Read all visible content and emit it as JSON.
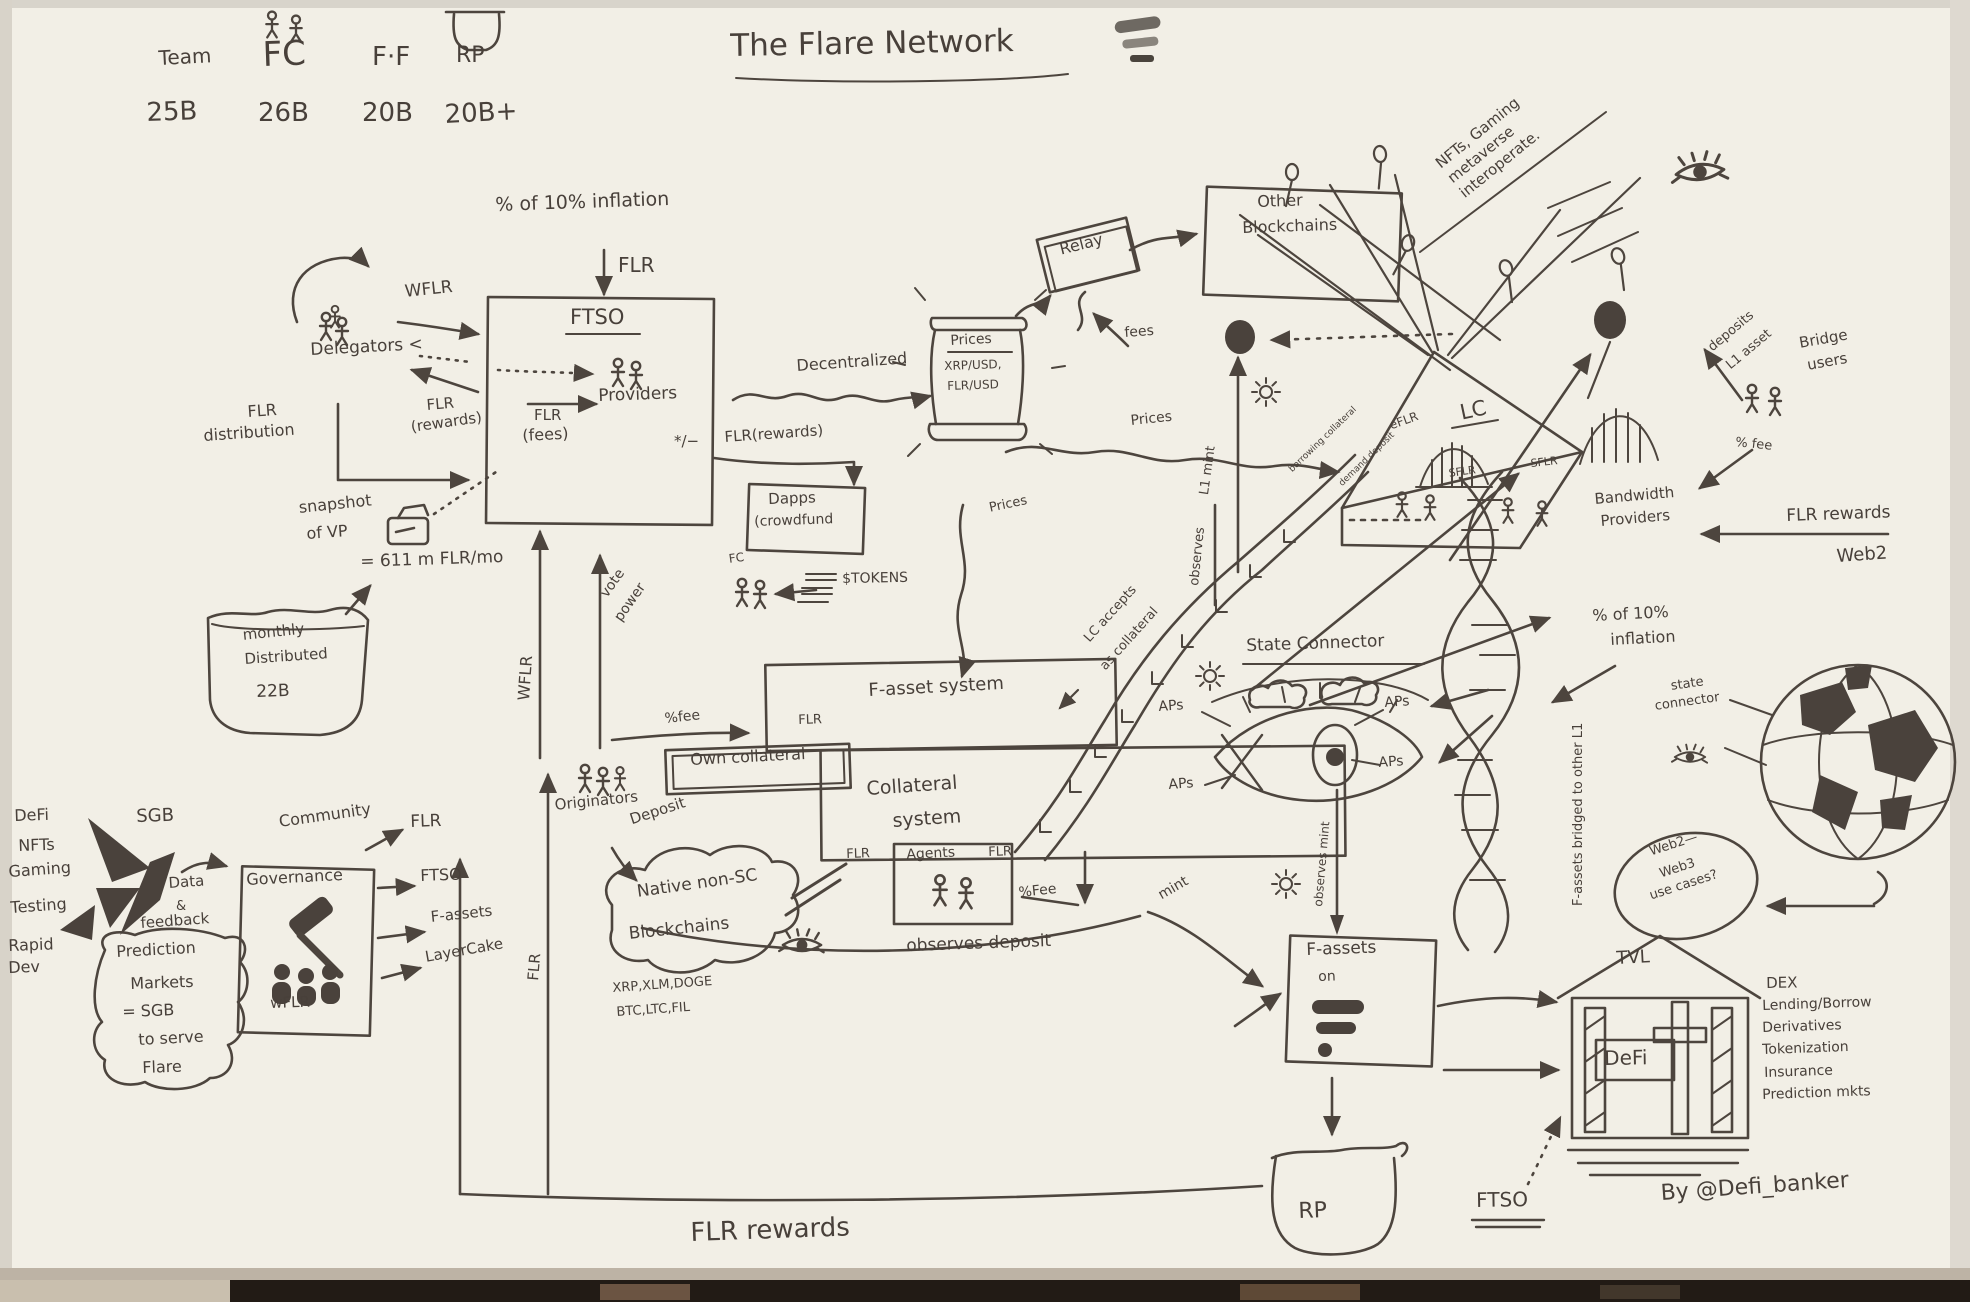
{
  "ink": "#4a423c",
  "header": {
    "team": "Team",
    "fc": "FC",
    "ff": "F·F",
    "rp": "RP",
    "team_val": "25B",
    "fc_val": "26B",
    "ff_val": "20B",
    "rp_val": "20B+"
  },
  "title": "The Flare Network",
  "inflation": {
    "pct": "% of 10% inflation",
    "flr": "FLR"
  },
  "ftso": {
    "name": "FTSO",
    "providers": "Providers",
    "flr": "FLR",
    "fees": "(fees)",
    "pm": "*/−",
    "wflr": "WFLR",
    "delegators": "Delegators <",
    "flr_r": "FLR",
    "rewards": "(rewards)",
    "flr_d": "FLR",
    "distribution": "distribution",
    "snapshot": "snapshot",
    "of_vp": "of VP",
    "rate": "= 611 m FLR/mo",
    "rewards_out": "FLR(rewards)"
  },
  "bucket": {
    "l1": "monthly",
    "l2": "Distributed",
    "l3": "22B"
  },
  "dapps": {
    "l1": "Dapps",
    "l2": "(crowdfund",
    "fc": "FC",
    "tokens": "$TOKENS"
  },
  "oracle": {
    "decentralized": "Decentralized",
    "prices": "Prices",
    "pair1": "XRP/USD,",
    "pair2": "FLR/USD",
    "relay": "Relay",
    "fees": "fees"
  },
  "chains": {
    "l1": "Other",
    "l2": "Blockchains"
  },
  "note": {
    "l1": "NFTs, Gaming",
    "l2": "metaverse",
    "l3": "interoperate."
  },
  "flows": {
    "wflr": "WFLR",
    "vote1": "vote",
    "vote2": "power",
    "flr": "FLR",
    "prices_r": "Prices",
    "prices_d": "Prices",
    "l1mint": "L1 mint",
    "observes": "observes",
    "accepts1": "LC accepts",
    "accepts2": "as collateral",
    "borrow": "borrowing collateral",
    "demand": "demand deposit"
  },
  "lc": {
    "name": "LC",
    "eflr": "eFLR",
    "sflr1": "SFLR",
    "sflr2": "SFLR",
    "bw1": "Bandwidth",
    "bw2": "Providers",
    "rewards": "FLR rewards",
    "pct10_1": "% of 10%",
    "pct10_2": "inflation"
  },
  "bridge": {
    "dep1": "deposits",
    "dep2": "L1 asset",
    "users1": "Bridge",
    "users2": "users",
    "fee": "% fee"
  },
  "sc": {
    "title": "State Connector",
    "ap1": "APs",
    "ap2": "APs",
    "ap3": "APs",
    "ap4": "APs",
    "observes_mint": "observes mint",
    "mint": "mint"
  },
  "fasset": {
    "system": "F-asset system",
    "flr": "FLR",
    "fee": "%fee",
    "own": "Own collateral",
    "col1": "Collateral",
    "col2": "system",
    "flr_l": "FLR",
    "agents": "Agents",
    "flr_r": "FLR",
    "fee2": "%Fee",
    "orig": "Originators",
    "deposit": "Deposit",
    "obs_dep": "observes deposit",
    "helix": "F-assets bridged to other L1"
  },
  "cloud": {
    "l1": "Native non-SC",
    "l2": "Blockchains",
    "c1": "XRP,XLM,DOGE",
    "c2": "BTC,LTC,FIL"
  },
  "left": {
    "i1": "DeFi",
    "i2": "NFTs",
    "i3": "Gaming",
    "i4": "Testing",
    "i5": "Rapid",
    "i6": "Dev",
    "sgb": "SGB",
    "data": "Data",
    "amp": "&",
    "feedback": "feedback"
  },
  "prediction": {
    "l1": "Prediction",
    "l2": "Markets",
    "l3": "= SGB",
    "l4": "to serve",
    "l5": "Flare"
  },
  "gov": {
    "community": "Community",
    "name": "Governance",
    "wflr": "wFLR",
    "a1": "FLR",
    "a2": "FTSO",
    "a3": "F-assets",
    "a4": "LayerCake"
  },
  "right": {
    "web2": "Web2",
    "sc1": "state",
    "sc2": "connector",
    "oval1": "Web2—",
    "oval2": "Web3",
    "oval3": "use cases?",
    "tvl": "TVL",
    "defi": "DeFi",
    "dex": "DEX",
    "lend": "Lending/Borrow",
    "der": "Derivatives",
    "tok": "Tokenization",
    "ins": "Insurance",
    "pred": "Prediction mkts"
  },
  "fbox": {
    "l1": "F-assets",
    "l2": "on"
  },
  "rp": "RP",
  "bottom": {
    "rewards": "FLR rewards",
    "ftso": "FTSO",
    "credit": "By @Defi_banker"
  }
}
